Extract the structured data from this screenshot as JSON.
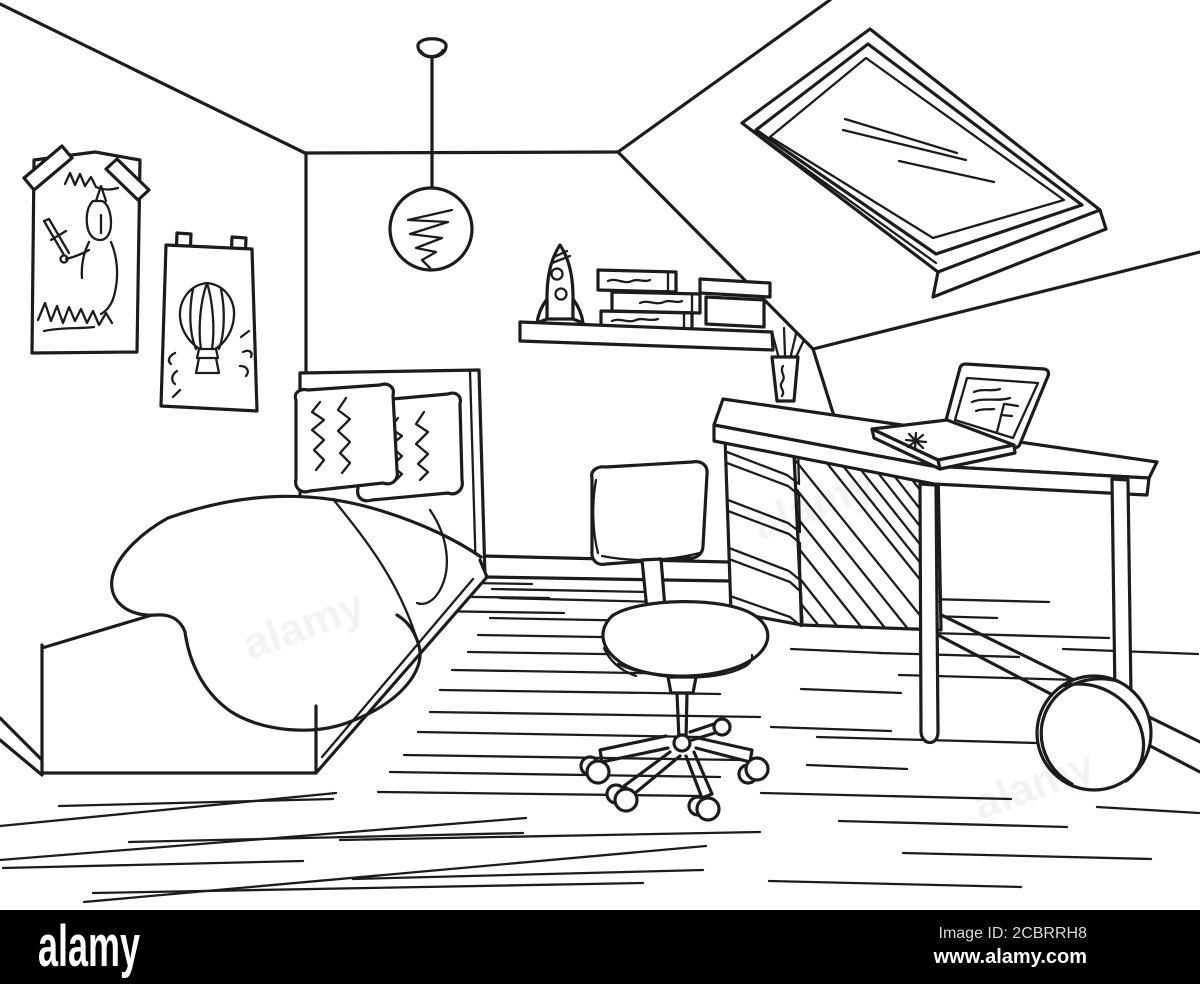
{
  "artwork": {
    "ink_color": "#1c1c1c",
    "background_color": "#ffffff",
    "objects": [
      "bed",
      "pillows",
      "blanket",
      "headboard",
      "knight-poster",
      "hot-air-balloon-poster",
      "pendant-lamp",
      "wall-shelf",
      "toy-rocket",
      "books",
      "storage-box",
      "skylight-window",
      "sloped-ceiling",
      "desk",
      "drawer-unit",
      "laptop",
      "pen-cup",
      "office-chair",
      "ball",
      "wooden-floor",
      "baseboard"
    ]
  },
  "watermark": {
    "ghost_label": "alamy"
  },
  "watermark_bar": {
    "background": "#000000",
    "brand": "alamy",
    "image_id": "Image ID: 2CBRRH8",
    "url": "www.alamy.com"
  }
}
